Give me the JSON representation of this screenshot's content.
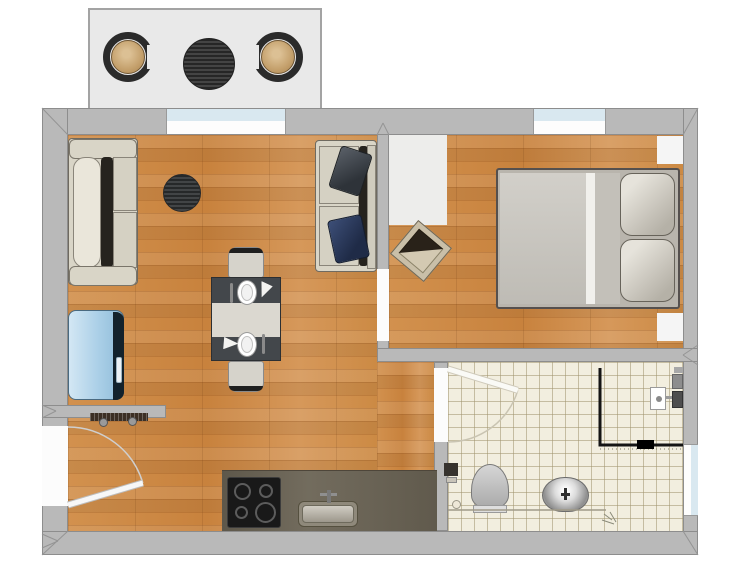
{
  "canvas": {
    "width": 753,
    "height": 576
  },
  "colors": {
    "wall": "#b9b9b9",
    "wall-outline": "#8d8d8d",
    "balcony": "#e9e9e9",
    "glass": "#d9e8f0",
    "tile": "#f2eedf",
    "wood-base": "#cd8a46",
    "counter": "#6b6455",
    "sofa": "#d9d5c7",
    "furn-line": "#6f6a60",
    "chair": "#d6d3cb",
    "table-dark": "#43474b",
    "runner": "#dbd8d0",
    "bed-duvet": "#cac7c0",
    "wicker": "#2b2b2b",
    "pillow-dark": "#3e434a",
    "pillow-navy": "#2c3a5a",
    "blue-chest": "#aacfe7",
    "cushion-tan": "#c4a06c"
  },
  "rooms": [
    {
      "id": "balcony",
      "label": "balcony"
    },
    {
      "id": "living-room",
      "label": "living-room-with-open-kitchen"
    },
    {
      "id": "bedroom",
      "label": "bedroom"
    },
    {
      "id": "bathroom",
      "label": "bathroom"
    }
  ],
  "furniture": {
    "balcony": [
      "wicker-chair",
      "round-bistro-table",
      "wicker-chair"
    ],
    "living_room": [
      "two-seat-sofa",
      "dark-round-rug",
      "two-seat-sofa-with-pillows",
      "light-blue-chest",
      "radiator",
      "dining-table-with-runner",
      "dining-chair",
      "dining-chair",
      "kitchen-counter",
      "cooktop-4-burners",
      "kitchen-sink"
    ],
    "bedroom": [
      "white-rug",
      "ottoman",
      "double-bed-with-two-pillows",
      "nightstand",
      "nightstand"
    ],
    "bathroom": [
      "corner-shower-with-glass-partition",
      "shower-fixture",
      "toilet",
      "toilet-paper-holder",
      "round-wash-basin"
    ]
  },
  "openings": {
    "windows": [
      "living-room-window-top",
      "bedroom-window-top",
      "bathroom-window-right"
    ],
    "doors": [
      "entrance-door-left-wall",
      "bedroom-doorway",
      "bathroom-door"
    ]
  }
}
